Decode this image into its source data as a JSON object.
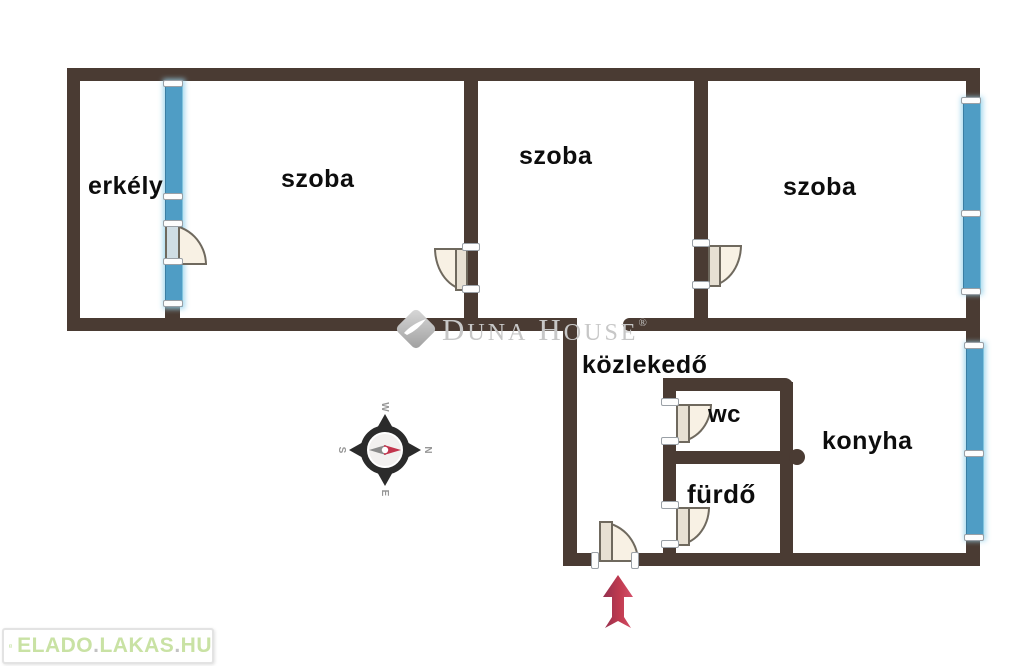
{
  "floorplan": {
    "title": "apartment floor plan",
    "rooms": [
      {
        "id": "erkely",
        "label": "erkély"
      },
      {
        "id": "szoba-1",
        "label": "szoba"
      },
      {
        "id": "szoba-2",
        "label": "szoba"
      },
      {
        "id": "szoba-3",
        "label": "szoba"
      },
      {
        "id": "kozlekedo",
        "label": "közlekedő"
      },
      {
        "id": "wc",
        "label": "wc"
      },
      {
        "id": "furdo",
        "label": "fürdő"
      },
      {
        "id": "konyha",
        "label": "konyha"
      }
    ],
    "colors": {
      "wall": "#4a3b33",
      "window": "#4f9dc5",
      "door_fill": "#f8f1e4",
      "door_outline": "#6f695e",
      "entrance_arrow": "#b93a4d",
      "watermark_gray": "#c7c7c7",
      "brand_green": "#c9e2a4"
    }
  },
  "compass": {
    "north": "N",
    "south": "S",
    "east": "E",
    "west": "W"
  },
  "watermark": {
    "word1_initial": "D",
    "word1_rest": "UNA",
    "word2_initial": "H",
    "word2_rest": "OUSE",
    "registered": "®"
  },
  "footer_logo": {
    "part1": "ELADO",
    "dot1": ".",
    "part2": "LAKAS",
    "dot2": ".",
    "part3": "HU"
  }
}
